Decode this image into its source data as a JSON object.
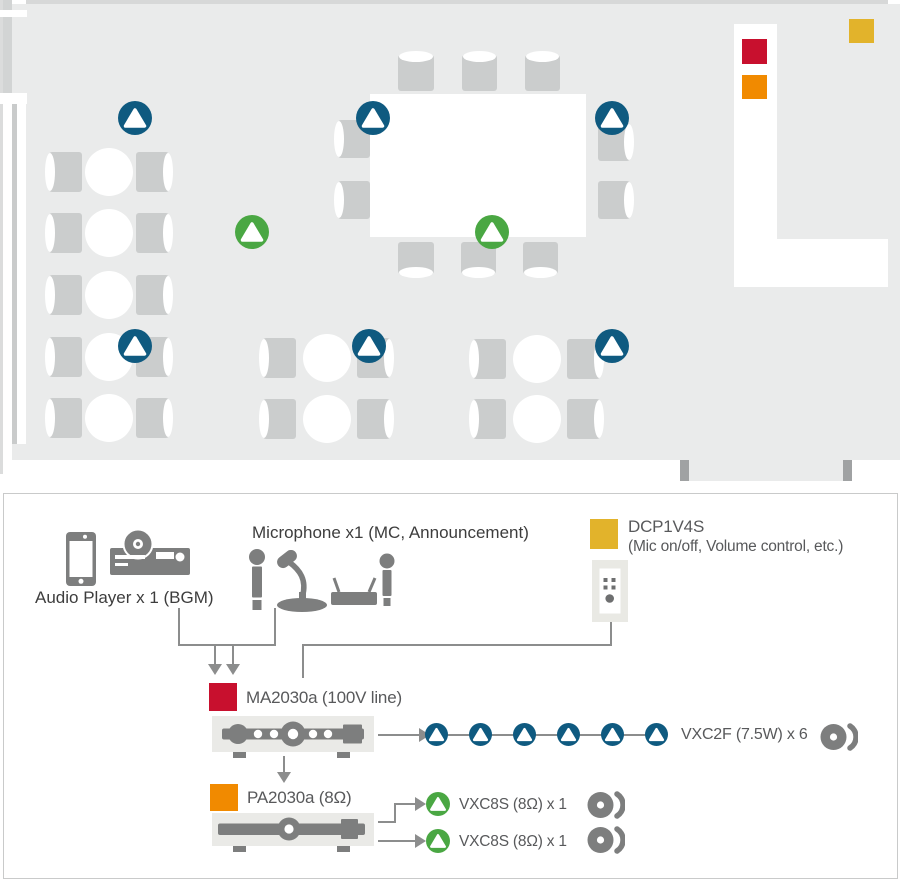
{
  "colors": {
    "speaker_blue": "#0f5a80",
    "speaker_green": "#4aa743",
    "square_red": "#c8102e",
    "square_orange": "#f18a00",
    "square_yellow": "#e2b32b",
    "device_gray": "#7d7e7e",
    "line_gray": "#8c8d8d",
    "label_gray": "#58595b",
    "label_dark": "#3d3d3d",
    "floor_gray": "#eaebeb",
    "furniture_gray": "#cbcdcd"
  },
  "floor_plan": {
    "ceiling_speakers_blue_count": 6,
    "surface_speakers_green_count": 2,
    "controller_markers": [
      "red",
      "orange",
      "yellow"
    ]
  },
  "equipment": {
    "audio_player": {
      "label": "Audio Player x 1 (BGM)",
      "icons": [
        "smartphone-icon",
        "cd-player-icon"
      ]
    },
    "microphone": {
      "label": "Microphone x1 (MC, Announcement)",
      "icons": [
        "handheld-mic-icon",
        "gooseneck-mic-icon",
        "wireless-mic-set-icon"
      ]
    },
    "wall_controller": {
      "model": "DCP1V4S",
      "description": "(Mic on/off, Volume control, etc.)",
      "icon": "wall-panel-icon"
    },
    "mixer_amp": {
      "label": "MA2030a (100V line)",
      "icon": "amplifier-icon"
    },
    "power_amp": {
      "label": "PA2030a (8Ω)",
      "icon": "amplifier-icon"
    },
    "speaker_lines": {
      "ceiling_line": {
        "label": "VXC2F (7.5W) x 6",
        "count": 6,
        "icon": "ceiling-speaker-icon"
      },
      "surface_line_1": {
        "label": "VXC8S (8Ω) x 1",
        "icon": "surface-speaker-icon"
      },
      "surface_line_2": {
        "label": "VXC8S (8Ω) x 1",
        "icon": "surface-speaker-icon"
      }
    }
  }
}
